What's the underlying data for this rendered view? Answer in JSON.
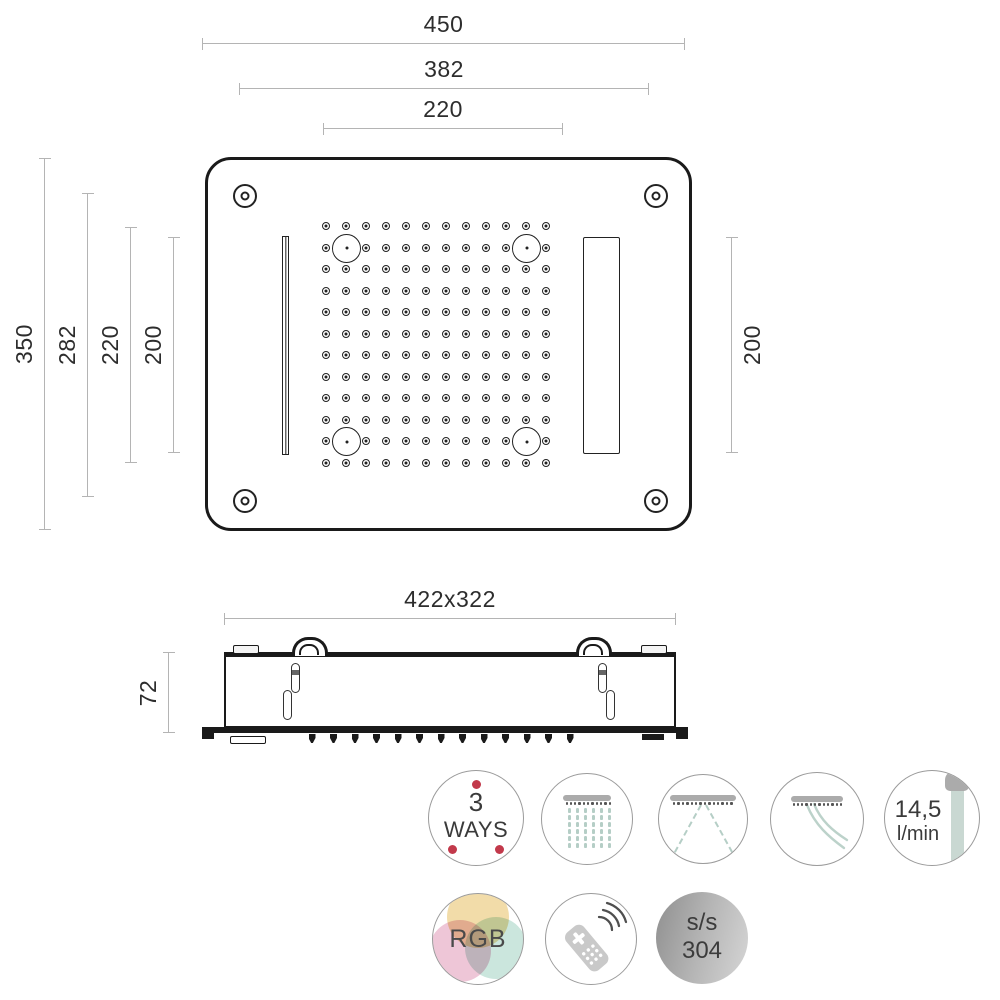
{
  "colors": {
    "line": "#1a1a1a",
    "dim_line": "#b4b4b4",
    "text": "#2d2d2d",
    "accent_red": "#c2394b",
    "water": "#b5cec6",
    "icon_gray": "#ababab",
    "steel_dark": "#8f8f8f",
    "steel_light": "#d6d6d6"
  },
  "dims": {
    "d450": "450",
    "d382": "382",
    "d220_top": "220",
    "d350": "350",
    "d282": "282",
    "d220_left": "220",
    "d200_left": "200",
    "d200_right": "200",
    "side_size": "422x322",
    "d72": "72"
  },
  "top_view": {
    "grid": {
      "cols": 12,
      "rows": 12,
      "origin_x": 119,
      "origin_y": 67,
      "dx": 20,
      "dy": 21.5,
      "led_cells": [
        [
          1,
          1
        ],
        [
          10,
          1
        ],
        [
          1,
          10
        ],
        [
          10,
          10
        ]
      ]
    }
  },
  "side_view": {
    "teeth": {
      "count": 13,
      "start_x": 312,
      "y": 734,
      "dx": 21.5
    }
  },
  "icons": {
    "three_ways": {
      "line1": "3",
      "line2": "WAYS"
    },
    "flow": {
      "line1": "14,5",
      "line2": "l/min"
    },
    "rgb": {
      "label": "RGB"
    },
    "stainless": {
      "line1": "s/s",
      "line2": "304"
    }
  }
}
